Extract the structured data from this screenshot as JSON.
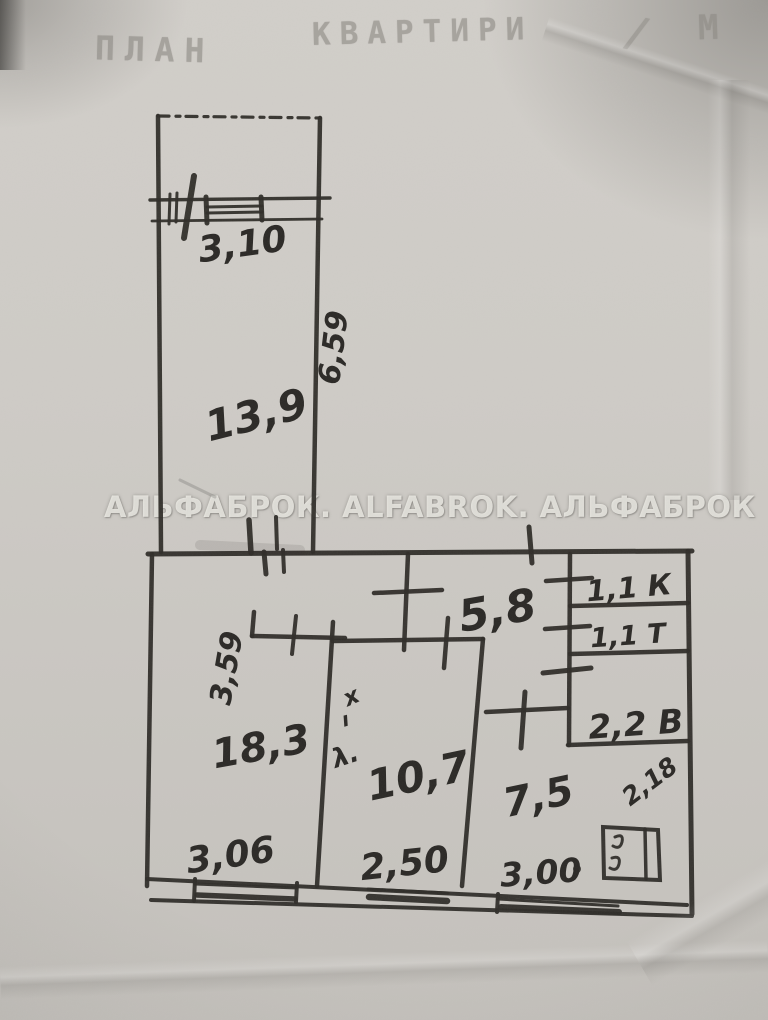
{
  "header": {
    "title_word1": "ПЛАН",
    "title_word2": "КВАРТИРИ",
    "separator": "/",
    "title_word3": "М"
  },
  "watermark": "АЛЬФАБРОК. ALFABROK. АЛЬФАБРОК",
  "rooms": [
    {
      "id": "room-top",
      "area_label": "13,9"
    },
    {
      "id": "room-left",
      "area_label": "18,3"
    },
    {
      "id": "room-mid",
      "area_label": "10,7"
    },
    {
      "id": "hallway",
      "area_label": "5,8"
    },
    {
      "id": "kitchen",
      "area_label": "7,5"
    },
    {
      "id": "closet",
      "area_label": "1,1 К"
    },
    {
      "id": "toilet",
      "area_label": "1,1 Т"
    },
    {
      "id": "bathroom",
      "area_label": "2,2 В"
    }
  ],
  "dimensions": [
    {
      "id": "dim-window-top",
      "label": "3,10"
    },
    {
      "id": "dim-side-top",
      "label": "6,59",
      "rotated": true
    },
    {
      "id": "dim-side-left",
      "label": "3,59",
      "rotated": true
    },
    {
      "id": "dim-bottom-left",
      "label": "3,06"
    },
    {
      "id": "dim-bottom-mid",
      "label": "2,50"
    },
    {
      "id": "dim-bottom-right",
      "label": "3,00"
    },
    {
      "id": "dim-diag-right",
      "label": "2,18"
    }
  ],
  "annotations": [
    {
      "id": "mark-x",
      "label": "х"
    },
    {
      "id": "mark-tick",
      "label": "ı"
    },
    {
      "id": "mark-lambda",
      "label": "λ."
    }
  ],
  "colors": {
    "paper": "#cdcac5",
    "ink": "#2e2c28",
    "faded_header": "#8d8a84",
    "watermark": "#f2f0ea"
  }
}
